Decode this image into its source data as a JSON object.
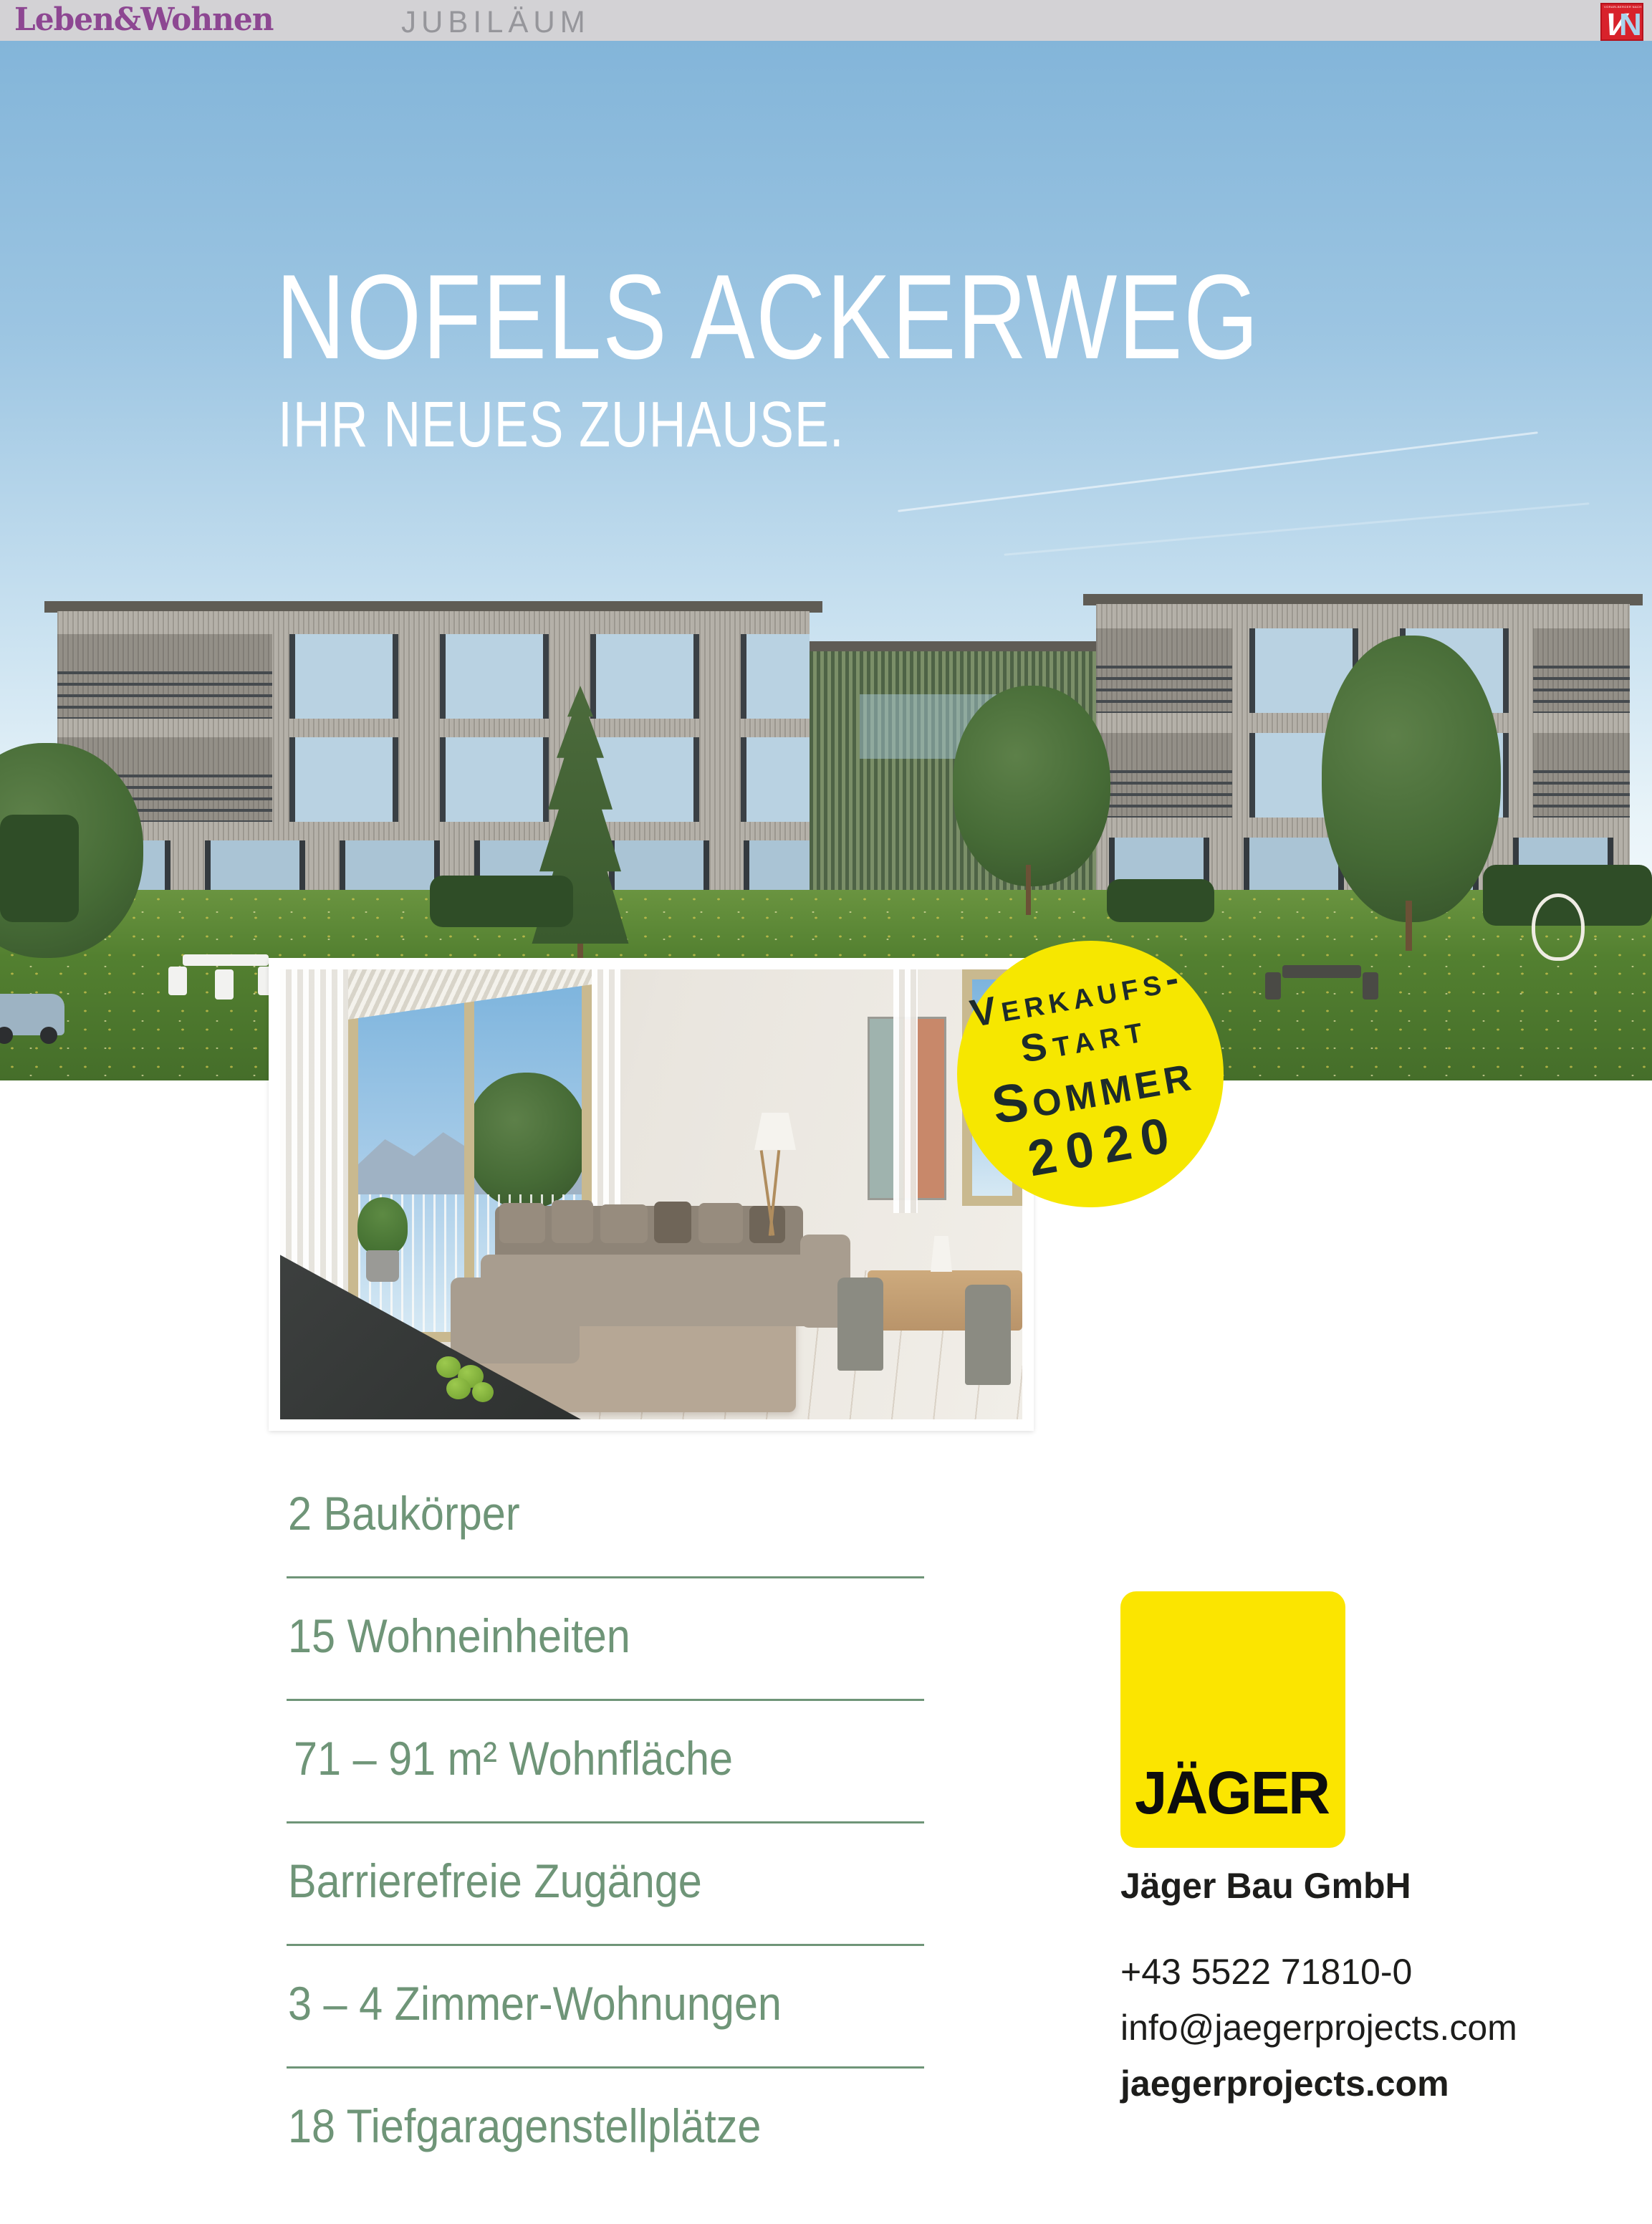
{
  "colors": {
    "brand_purple": "#8d4792",
    "masthead_gray": "#d3d2d5",
    "vn_red": "#d8222b",
    "badge_yellow": "#f6e700",
    "logo_yellow": "#fbe500",
    "feature_green": "#6f9578",
    "text_black": "#1d1d1b"
  },
  "masthead": {
    "brand": "Leben&Wohnen",
    "section": "JUBILÄUM",
    "newspaper_logo": {
      "letter_v": "V",
      "letter_n": "N",
      "caption": "VORARLBERGER NACHRICHTEN"
    }
  },
  "hero": {
    "title": "NOFELS ACKERWEG",
    "subtitle": "IHR NEUES ZUHAUSE."
  },
  "badge": {
    "line1": "Verkaufs-",
    "line2": "Start",
    "line3": "Sommer",
    "line4": "2020"
  },
  "features": {
    "items": [
      "2 Baukörper",
      "15 Wohneinheiten",
      "71 – 91 m² Wohnfläche",
      "Barrierefreie Zugänge",
      "3 – 4 Zimmer-Wohnungen",
      "18 Tiefgaragenstellplätze"
    ]
  },
  "company": {
    "logo_text": "JÄGER",
    "name": "Jäger Bau GmbH",
    "phone": "+43 5522 71810-0",
    "email": "info@jaegerprojects.com",
    "website": "jaegerprojects.com"
  }
}
